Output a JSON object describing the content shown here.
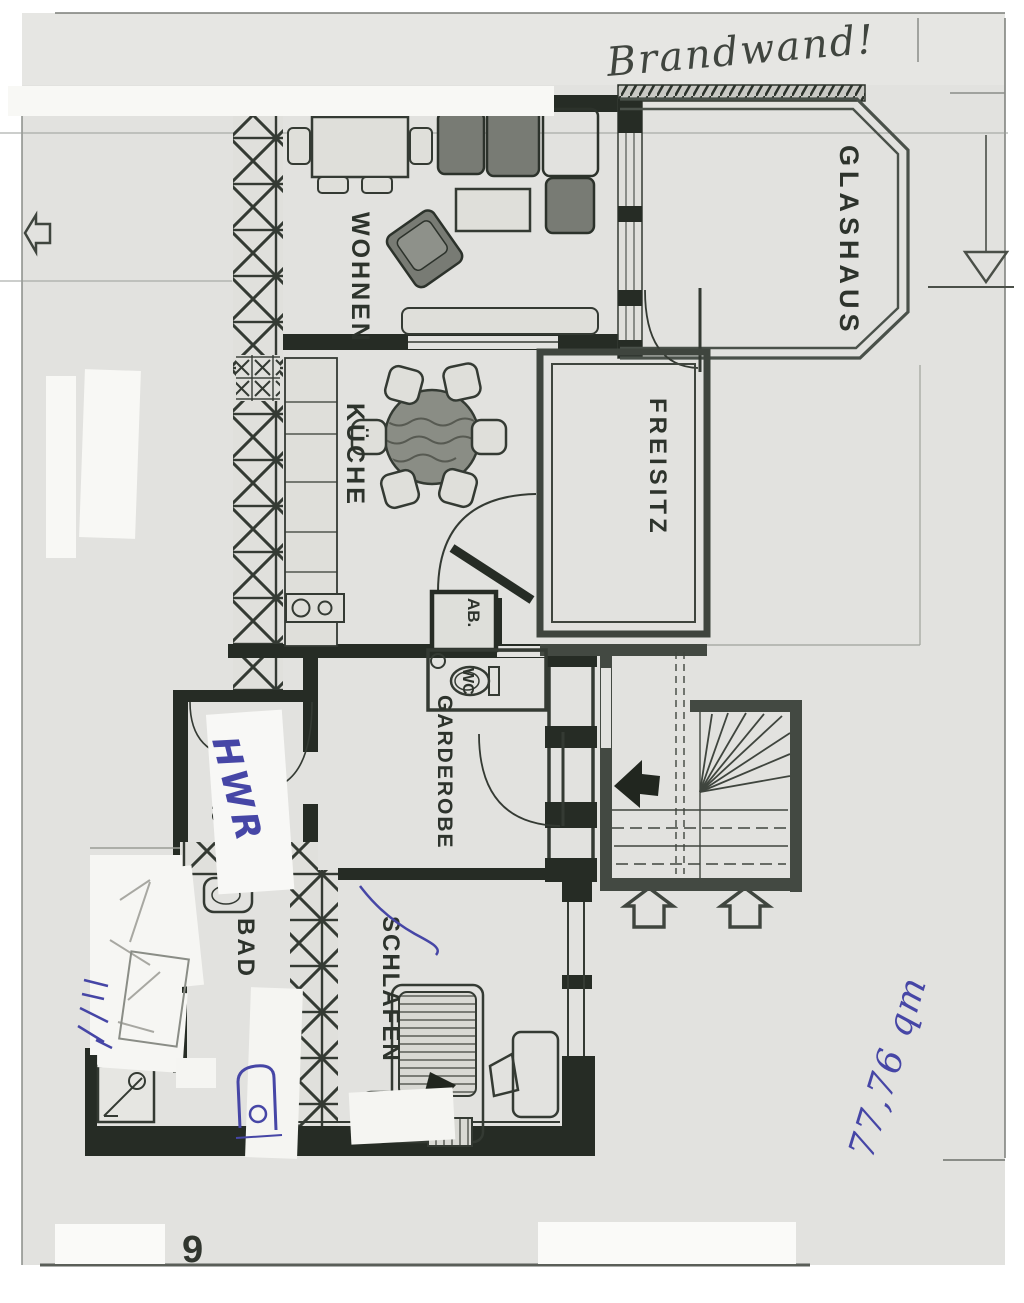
{
  "document": {
    "type": "scanned floor plan",
    "page_number": "9"
  },
  "annotations": {
    "brandwand": "Brandwand!",
    "area_note": "77,76 qm",
    "hwr_note": "HWR"
  },
  "rooms": {
    "wohnen": "WOHNEN",
    "glashaus": "GLASHAUS",
    "kueche": "KÜCHE",
    "freisitz": "FREISITZ",
    "ab": "AB.",
    "wc": "WC",
    "garderobe": "GARDEROBE",
    "buero": "BÜRO",
    "bad": "BAD",
    "schlafen": "SCHLAFEN"
  },
  "colors": {
    "paper": "#e2e2df",
    "ink": "#262c25",
    "wall_gray": "#434942",
    "blue_ink": "#4646a6",
    "patch_white": "#f8f8f5"
  }
}
